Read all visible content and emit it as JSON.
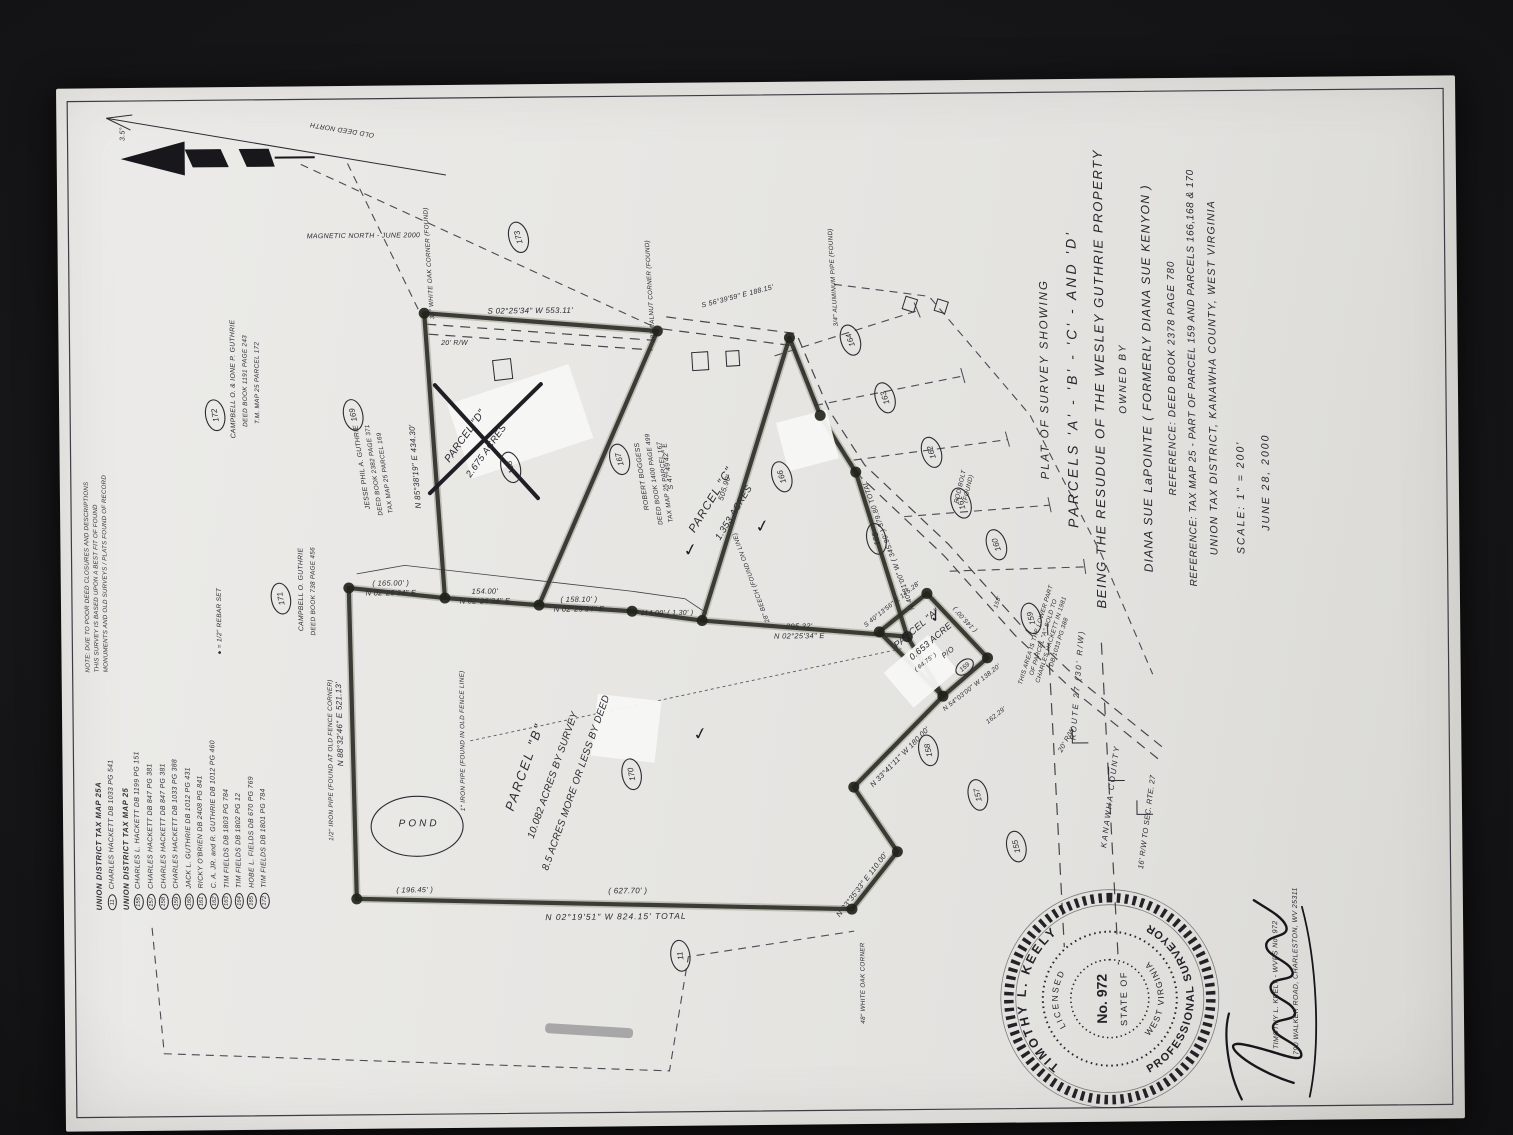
{
  "colors": {
    "ink": "#2b2b31",
    "heavy": "#2f3129",
    "heavy_glow": "#7d8470",
    "paper": "#e8e7e4",
    "photo_bg": "#121214"
  },
  "title_block": {
    "lines": [
      "PLAT OF SURVEY SHOWING",
      "PARCELS 'A' - 'B' - 'C' - AND 'D'",
      "BEING THE RESUDUE OF THE WESLEY GUTHRIE PROPERTY",
      "OWNED BY",
      "DIANA SUE LaPOINTE ( FORMERLY DIANA SUE KENYON )",
      "REFERENCE: DEED BOOK 2378  PAGE 780",
      "REFERENCE: TAX MAP 25 - PART OF PARCEL 159 AND PARCELS 166,168 & 170",
      "UNION TAX DISTRICT, KANAWHA COUNTY, WEST VIRGINIA",
      "SCALE:  1\" = 200'",
      "JUNE 28, 2000"
    ]
  },
  "legend": {
    "note_lines": [
      "NOTE: DUE TO POOR DEED CLOSURES AND DESCRIPTIONS",
      "THIS SURVEY IS BASED UPON A BEST FIT OF FOUND",
      "MONUMENTS AND OLD SURVEYS / PLATS FOUND OF RECORD"
    ],
    "rebar_note": "●  =  1/2\" REBAR SET",
    "sections": [
      {
        "header": "UNION DISTRICT TAX MAP 25A",
        "items": [
          {
            "num": "11",
            "text": "CHARLES HACKETT   DB 1033 PG 541"
          }
        ]
      },
      {
        "header": "UNION DISTRICT TAX MAP 25",
        "items": [
          {
            "num": "155",
            "text": "CHARLES L. HACKETT   DB 1199 PG 151"
          },
          {
            "num": "157",
            "text": "CHARLES HACKETT   DB 847 PG 381"
          },
          {
            "num": "158",
            "text": "CHARLES HACKETT   DB 847 PG 381"
          },
          {
            "num": "159",
            "text": "CHARLES HACKETT   DB 1033 PG 388"
          },
          {
            "num": "160",
            "text": "JACK L. GUTHRIE   DB 1012 PG 431"
          },
          {
            "num": "161",
            "text": "RICKY O'BRIEN   DB 2408 PG 841"
          },
          {
            "num": "162",
            "text": "C. A. JR. and R. GUTHRIE   DB 1012 PG 460"
          },
          {
            "num": "163",
            "text": "TIM FIELDS   DB 1803 PG 784"
          },
          {
            "num": "164",
            "text": "TIM FIELDS   DB 1802 PG 12"
          },
          {
            "num": "165",
            "text": "HOBE L. FIELDS   DB 670 PG 769"
          },
          {
            "num": "172",
            "text": "TIM FIELDS   DB 1801 PG 784"
          }
        ]
      }
    ]
  },
  "stamp": {
    "arc_top": "TIMOTHY L. KEELY",
    "arc_bottom": "PROFESSIONAL SURVEYOR",
    "arc_inner_top": "LICENSED",
    "arc_inner_bottom": "WEST VIRGINIA",
    "center_line1": "No. 972",
    "center_line2": "STATE OF",
    "address_line1": "TIMOTHY L. KEELY  -  WVPS No. 972",
    "address_line2": "790 WALKER ROAD, CHARLESTON, WV  25311"
  },
  "map_labels": [
    {
      "t": "PARCEL  \"B\"",
      "x": 352,
      "y": 462,
      "r": 20,
      "s": 13,
      "ls": 2
    },
    {
      "t": "10.082 ACRES BY SURVEY",
      "x": 344,
      "y": 489,
      "r": 20,
      "s": 10
    },
    {
      "t": "8.5 ACRES MORE OR LESS BY DEED",
      "x": 336,
      "y": 512,
      "r": 20,
      "s": 10
    },
    {
      "t": "PARCEL  \"C\"",
      "x": 617,
      "y": 650,
      "r": 32,
      "s": 11.5,
      "ls": 1
    },
    {
      "t": "1.353 ACRES",
      "x": 604,
      "y": 672,
      "r": 32,
      "s": 9.5
    },
    {
      "t": "PARCEL  \"A\"",
      "x": 486,
      "y": 853,
      "r": 50,
      "s": 9.5
    },
    {
      "t": "0.653 ACRE",
      "x": 473,
      "y": 867,
      "r": 50,
      "s": 9
    },
    {
      "t": "P/O",
      "x": 462,
      "y": 884,
      "r": 50,
      "s": 7.5
    },
    {
      "t": "PARCEL  \"D\"",
      "x": 683,
      "y": 404,
      "r": 36,
      "s": 10.5
    },
    {
      "t": "2.675 ACRES",
      "x": 668,
      "y": 425,
      "r": 36,
      "s": 9.5
    },
    {
      "t": "POND",
      "x": 295,
      "y": 352,
      "r": 90,
      "s": 10,
      "ls": 3
    },
    {
      "t": "JESSE PHIL A. GUTHRIE",
      "x": 655,
      "y": 300,
      "r": -8,
      "s": 6.8
    },
    {
      "t": "DEED BOOK 2382 PAGE 371",
      "x": 652,
      "y": 312,
      "r": -8,
      "s": 6.4
    },
    {
      "t": "TAX MAP 25 PARCEL 169",
      "x": 649,
      "y": 323,
      "r": -8,
      "s": 6.4
    },
    {
      "t": "ROBERT  BOGGESS",
      "x": 643,
      "y": 580,
      "r": -8,
      "s": 6.8
    },
    {
      "t": "DEED BOOK 1400 PAGE 499",
      "x": 640,
      "y": 592,
      "r": -8,
      "s": 6.4
    },
    {
      "t": "TAX MAP 25 PARCEL 167",
      "x": 637,
      "y": 603,
      "r": -8,
      "s": 6.4
    },
    {
      "t": "CAMPBELL O. GUTHRIE",
      "x": 533,
      "y": 238,
      "r": 0,
      "s": 6.8
    },
    {
      "t": "DEED BOOK 738 PAGE 456",
      "x": 531,
      "y": 250,
      "r": 0,
      "s": 6.4
    },
    {
      "t": "CAMPBELL O. & IONE P. GUTHRIE",
      "x": 744,
      "y": 172,
      "r": 0,
      "s": 6.8
    },
    {
      "t": "DEED BOOK 1191 PAGE 243",
      "x": 742,
      "y": 184,
      "r": 0,
      "s": 6.4
    },
    {
      "t": "T.M. MAP 25 PARCEL 172",
      "x": 740,
      "y": 196,
      "r": 0,
      "s": 6.4
    },
    {
      "lines": [
        "THIS AREA IS THE LOWER PART",
        "OF PARCEL \"A\" SOLD TO",
        "CHARLES HACKETT IN 1981",
        "DB 1033 PG 388"
      ],
      "x": 480,
      "y": 972,
      "r": 18,
      "s": 6.2
    },
    {
      "lines": [
        "( 165.00' )",
        "N 02°25'34\" E"
      ],
      "x": 536,
      "y": 326,
      "r": 90,
      "s": 7.5
    },
    {
      "lines": [
        "154.00'",
        "N 02°25'34\" E"
      ],
      "x": 527,
      "y": 420,
      "r": 90,
      "s": 7.5
    },
    {
      "lines": [
        "( 158.10' )",
        "N 02°25'34\" E"
      ],
      "x": 518,
      "y": 514,
      "r": 90,
      "s": 7.5
    },
    {
      "t": "114.00'   ( 1.30' )",
      "x": 504,
      "y": 602,
      "r": 90,
      "s": 7
    },
    {
      "lines": [
        "295.32'",
        "N 02°25'34\" E"
      ],
      "x": 489,
      "y": 734,
      "r": 90,
      "s": 7.5
    },
    {
      "t": "( 627.70' )",
      "x": 226,
      "y": 560,
      "r": 90,
      "s": 8
    },
    {
      "t": "N 02°19'51\" W     824.15'   TOTAL",
      "x": 200,
      "y": 548,
      "r": 90,
      "s": 8.5,
      "ls": 1
    },
    {
      "t": "( 196.45' )",
      "x": 229,
      "y": 347,
      "r": 90,
      "s": 7.5
    },
    {
      "t": "N 88°32'46\" E    521.13'",
      "x": 398,
      "y": 276,
      "r": -1,
      "s": 8
    },
    {
      "t": "N 85°38'19\" E    434.30'",
      "x": 655,
      "y": 354,
      "r": -4,
      "s": 8
    },
    {
      "t": "S 02°25'34\" W    553.11'",
      "x": 807,
      "y": 468,
      "r": 90,
      "s": 8
    },
    {
      "t": "20'  R/W",
      "x": 776,
      "y": 392,
      "r": 90,
      "s": 7
    },
    {
      "t": "505.90'",
      "x": 630,
      "y": 663,
      "r": 18,
      "s": 7.5
    },
    {
      "t": "N 40°31'00\" W   ( 345.90' )   379.80  TOTAL",
      "x": 572,
      "y": 826,
      "r": -20,
      "s": 7
    },
    {
      "t": "S 47°49'42\" E",
      "x": 653,
      "y": 606,
      "r": -8,
      "s": 7
    },
    {
      "t": "S 56°39'59\" E   188.15'",
      "x": 820,
      "y": 676,
      "r": 76,
      "s": 7
    },
    {
      "t": "N 33°35'33\" E   110.00'",
      "x": 231,
      "y": 796,
      "r": 38,
      "s": 7.5
    },
    {
      "t": "N 33°41'11\" W   180.00'",
      "x": 358,
      "y": 835,
      "r": 45,
      "s": 7.5
    },
    {
      "t": "N 54°03'00\" W  138.20'",
      "x": 427,
      "y": 907,
      "r": 52,
      "s": 6.5
    },
    {
      "t": "S 40°13'56\" E  145.28'",
      "x": 511,
      "y": 828,
      "r": 52,
      "s": 6.5
    },
    {
      "t": "( 145.00' )",
      "x": 498,
      "y": 901,
      "r": -42,
      "s": 6.5
    },
    {
      "t": "162.29'",
      "x": 399,
      "y": 931,
      "r": 52,
      "s": 6.5
    },
    {
      "t": "( 64.75' )",
      "x": 453,
      "y": 861,
      "r": 52,
      "s": 6
    },
    {
      "t": "158'",
      "x": 513,
      "y": 934,
      "r": 20,
      "s": 6
    },
    {
      "t": "38\" WHITE OAK CORNER (FOUND)",
      "x": 858,
      "y": 369,
      "r": -3,
      "s": 6.3
    },
    {
      "t": "28\" WALNUT CORNER (FOUND)",
      "x": 828,
      "y": 590,
      "r": -3,
      "s": 6.3
    },
    {
      "t": "3/4\" ALUMINUM PIPE (FOUND)",
      "x": 840,
      "y": 773,
      "r": -3,
      "s": 6.3
    },
    {
      "t": "28\" BEECH (FOUND ON LINE)",
      "x": 541,
      "y": 688,
      "r": -20,
      "s": 6.3
    },
    {
      "t": "1\" IRON PIPE (FOUND IN OLD FENCE LINE)",
      "x": 380,
      "y": 398,
      "r": 0,
      "s": 6.3
    },
    {
      "t": "1/2\" IRON PIPE (FOUND AT OLD FENCE CORNER)",
      "x": 362,
      "y": 266,
      "r": 0,
      "s": 6.3
    },
    {
      "lines": [
        "ROD BOLT",
        "(FOUND)"
      ],
      "x": 629,
      "y": 898,
      "r": 14,
      "s": 6.3
    },
    {
      "t": "48\" WHITE OAK CORNER",
      "x": 134,
      "y": 796,
      "r": 0,
      "s": 6.3
    },
    {
      "t": "ROUTE  27   (30'  R/W)",
      "x": 430,
      "y": 1014,
      "r": 5,
      "s": 8,
      "ls": 2
    },
    {
      "t": "KANAWHA   COUNTY",
      "x": 318,
      "y": 1046,
      "r": 8,
      "s": 8,
      "ls": 2
    },
    {
      "t": "16'  R/W  TO  SEC.  RTE.  27",
      "x": 292,
      "y": 1082,
      "r": 8,
      "s": 7.5
    },
    {
      "t": "20'  R/W",
      "x": 374,
      "y": 1002,
      "r": 30,
      "s": 7
    },
    {
      "t": "OLD  DEED  NORTH",
      "x": 994,
      "y": 282,
      "r": -80,
      "s": 6.8
    },
    {
      "t": "MAGNETIC  NORTH   -   JUNE  2000",
      "x": 884,
      "y": 302,
      "r": 90,
      "s": 7
    },
    {
      "t": "3.5°",
      "x": 990,
      "y": 64,
      "r": 0,
      "s": 7
    },
    {
      "t": "●   =   1/2\" REBAR SET",
      "x": 502,
      "y": 156,
      "r": 0,
      "s": 6.5
    }
  ],
  "badges": [
    {
      "n": "173",
      "x": 883,
      "y": 457,
      "r": -15
    },
    {
      "n": "172",
      "x": 708,
      "y": 152,
      "r": -10
    },
    {
      "n": "171",
      "x": 524,
      "y": 216,
      "r": -10
    },
    {
      "n": "169",
      "x": 707,
      "y": 290,
      "r": -12
    },
    {
      "n": "168",
      "x": 653,
      "y": 447,
      "r": -15
    },
    {
      "n": "167",
      "x": 660,
      "y": 556,
      "r": -15
    },
    {
      "n": "166",
      "x": 641,
      "y": 718,
      "r": -18
    },
    {
      "n": "165",
      "x": 578,
      "y": 812,
      "r": -12
    },
    {
      "n": "164",
      "x": 777,
      "y": 788,
      "r": -18
    },
    {
      "n": "163",
      "x": 719,
      "y": 822,
      "r": -18
    },
    {
      "n": "162",
      "x": 664,
      "y": 868,
      "r": -18
    },
    {
      "n": "161",
      "x": 613,
      "y": 897,
      "r": -18
    },
    {
      "n": "160",
      "x": 571,
      "y": 932,
      "r": -18
    },
    {
      "n": "159",
      "x": 497,
      "y": 966,
      "r": -15
    },
    {
      "n": "158",
      "x": 366,
      "y": 862,
      "r": -12
    },
    {
      "n": "157",
      "x": 321,
      "y": 911,
      "r": -12
    },
    {
      "n": "155",
      "x": 269,
      "y": 949,
      "r": -12
    },
    {
      "n": "170",
      "x": 345,
      "y": 565,
      "r": -10
    },
    {
      "n": "11",
      "x": 163,
      "y": 612,
      "r": -8
    },
    {
      "n": "159",
      "x": 449,
      "y": 899,
      "r": 50,
      "small": true
    }
  ],
  "signature_name": "Timothy L. Keely"
}
